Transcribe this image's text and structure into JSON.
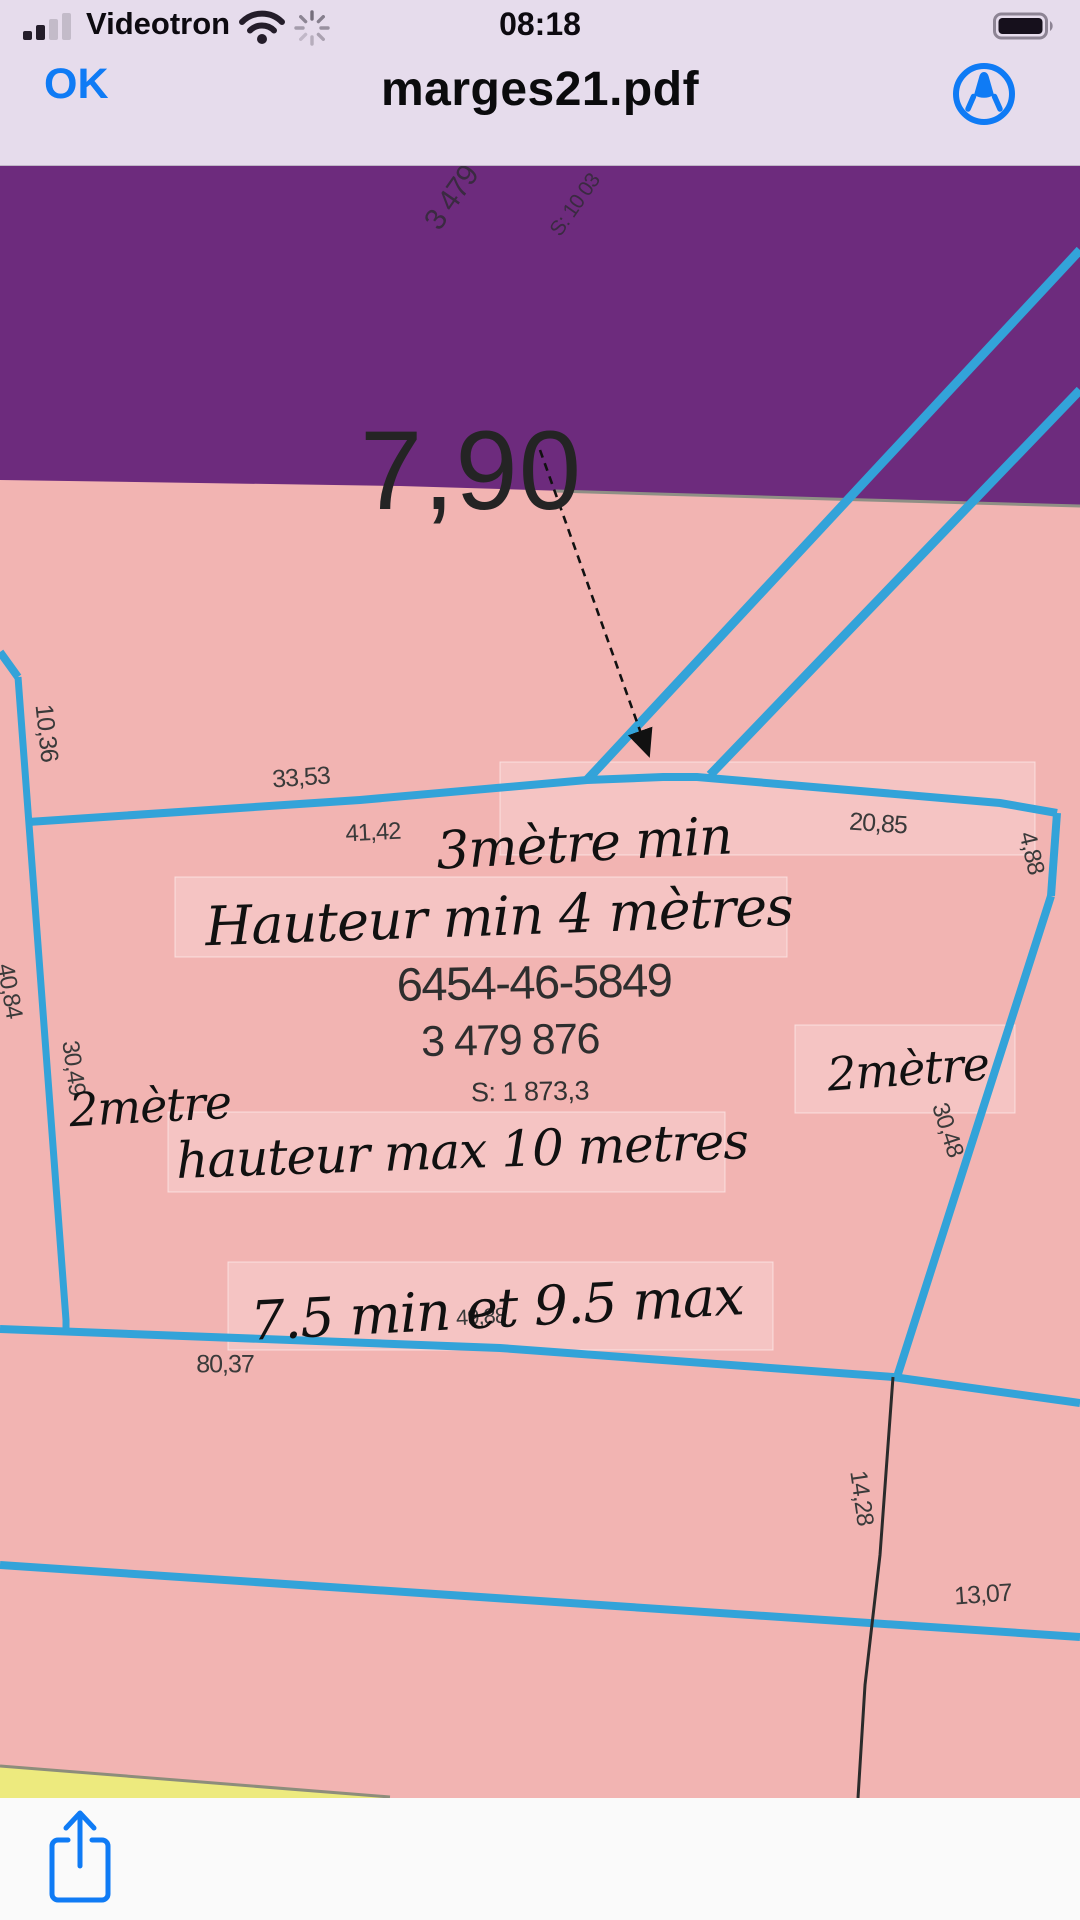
{
  "status_bar": {
    "carrier": "Videotron",
    "time": "08:18",
    "icons": [
      "cellular-signal-icon",
      "wifi-icon",
      "loading-spinner-icon",
      "battery-full-icon"
    ]
  },
  "nav_bar": {
    "ok_label": "OK",
    "title": "marges21.pdf",
    "markup_icon": "markup-pen-icon"
  },
  "toolbar": {
    "share_icon": "share-icon"
  },
  "colors": {
    "bar_background": "#e6dcec",
    "zone_purple": "#6d2b7d",
    "zone_pink": "#f2b4b2",
    "lot_line_blue": "#33a3d9",
    "ios_blue": "#0f7bf5",
    "yellow_zone": "#edea7e"
  },
  "map": {
    "labels": [
      {
        "text": "3 479",
        "x": 452,
        "y": 33,
        "rot": -55,
        "size": 30,
        "cls": "purple-label"
      },
      {
        "text": "S: 10 03",
        "x": 575,
        "y": 40,
        "rot": -55,
        "size": 21,
        "cls": "purple-label"
      },
      {
        "text": "7,90",
        "x": 471,
        "y": 306,
        "rot": 0,
        "size": 112,
        "cls": "big"
      },
      {
        "text": "10,36",
        "x": 46,
        "y": 568,
        "rot": 84,
        "size": 25,
        "cls": "dim"
      },
      {
        "text": "33,53",
        "x": 301,
        "y": 613,
        "rot": -4,
        "size": 25,
        "cls": "dim"
      },
      {
        "text": "41,42",
        "x": 373,
        "y": 668,
        "rot": -3,
        "size": 24,
        "cls": "dim"
      },
      {
        "text": "20,85",
        "x": 878,
        "y": 659,
        "rot": 4,
        "size": 25,
        "cls": "dim"
      },
      {
        "text": "4,88",
        "x": 1031,
        "y": 688,
        "rot": 77,
        "size": 24,
        "cls": "dim"
      },
      {
        "text": "40,84",
        "x": 9,
        "y": 826,
        "rot": 80,
        "size": 24,
        "cls": "dim"
      },
      {
        "text": "30,49",
        "x": 73,
        "y": 903,
        "rot": 82,
        "size": 24,
        "cls": "dim"
      },
      {
        "text": "30,48",
        "x": 947,
        "y": 965,
        "rot": 72,
        "size": 24,
        "cls": "dim"
      },
      {
        "text": "49,88",
        "x": 481,
        "y": 1152,
        "rot": -3,
        "size": 22,
        "cls": "dim"
      },
      {
        "text": "80,37",
        "x": 225,
        "y": 1200,
        "rot": 0,
        "size": 25,
        "cls": "dim"
      },
      {
        "text": "14,28",
        "x": 861,
        "y": 1333,
        "rot": 82,
        "size": 24,
        "cls": "dim"
      },
      {
        "text": "13,07",
        "x": 983,
        "y": 1430,
        "rot": -4,
        "size": 25,
        "cls": "dim"
      },
      {
        "text": "6454-46-5849",
        "x": 534,
        "y": 817,
        "rot": -1,
        "size": 47,
        "cls": "parcel"
      },
      {
        "text": "3 479 876",
        "x": 510,
        "y": 876,
        "rot": -1,
        "size": 43,
        "cls": "parcel"
      },
      {
        "text": "S: 1 873,3",
        "x": 530,
        "y": 927,
        "rot": -1,
        "size": 27,
        "cls": "parcel-s"
      },
      {
        "text": "3mètre min",
        "x": 584,
        "y": 679,
        "rot": -3,
        "size": 52,
        "cls": "hand"
      },
      {
        "text": "Hauteur min 4 mètres",
        "x": 499,
        "y": 752,
        "rot": -2,
        "size": 54,
        "cls": "hand"
      },
      {
        "text": "2mètre",
        "x": 150,
        "y": 941,
        "rot": -3,
        "size": 46,
        "cls": "hand"
      },
      {
        "text": "2mètre",
        "x": 908,
        "y": 904,
        "rot": -4,
        "size": 46,
        "cls": "hand"
      },
      {
        "text": "hauteur max 10 metres",
        "x": 462,
        "y": 986,
        "rot": -2,
        "size": 50,
        "cls": "hand"
      },
      {
        "text": "7.5 min et 9.5 max",
        "x": 497,
        "y": 1144,
        "rot": -3,
        "size": 54,
        "cls": "hand"
      }
    ]
  }
}
